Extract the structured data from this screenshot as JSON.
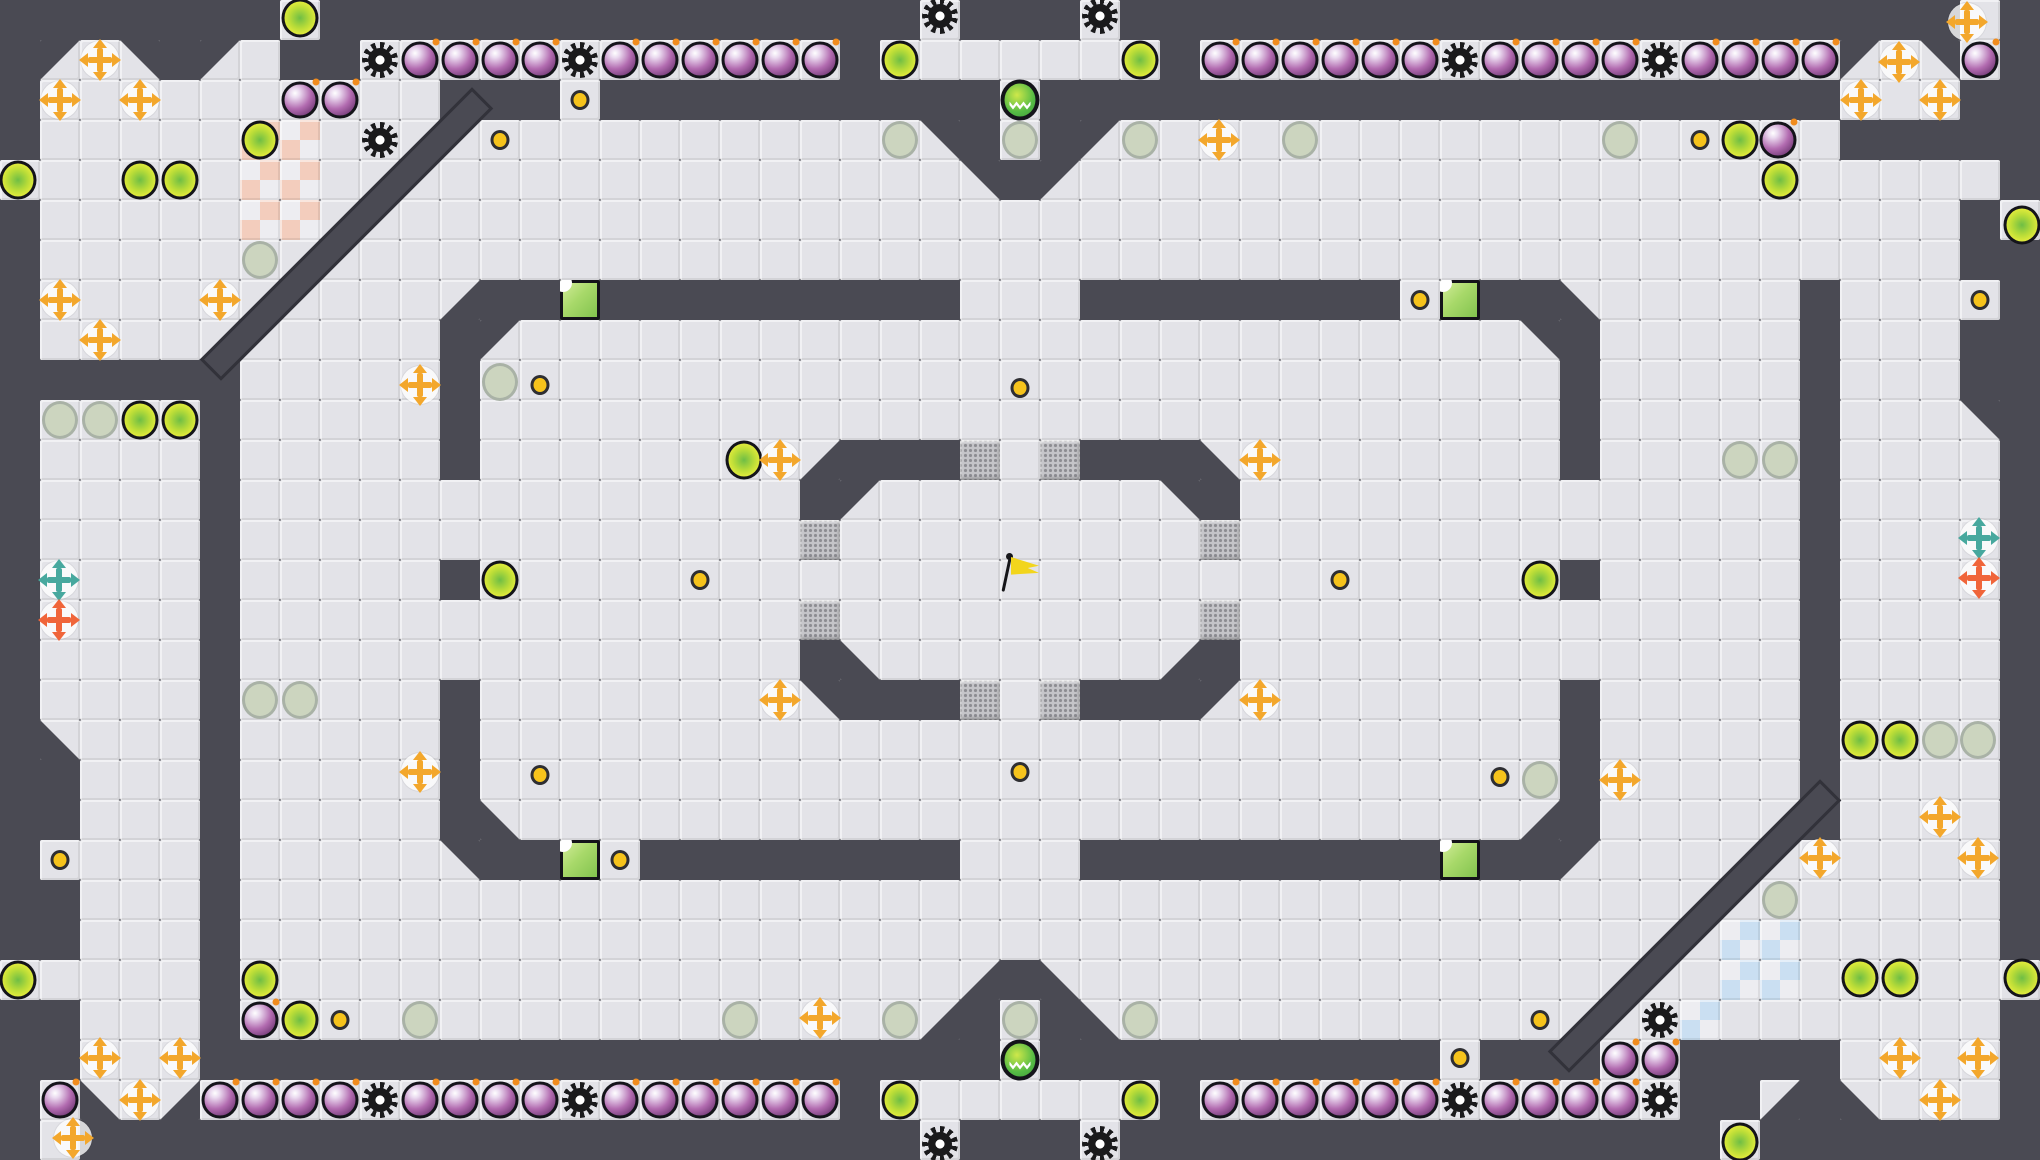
{
  "meta": {
    "description": "Top-down tile maze game map (capture-the-flag style) with neutral yellow flag at center, bomb rows, spike gears, boost pads, power-up crosses, gates, team end-zones and portals",
    "viewport": {
      "width": 2040,
      "height": 1160
    }
  },
  "map": {
    "tile": 40,
    "cols": 51,
    "rows": 29,
    "legend": {
      "#": "wall",
      ".": "floor",
      "A": "diagonal-wall-top-left",
      "B": "diagonal-wall-top-right",
      "C": "diagonal-wall-bottom-left",
      "D": "diagonal-wall-bottom-right",
      "R": "red-endzone-checker",
      "U": "blue-endzone-checker",
      "G": "gate",
      "Q": "green-button"
    },
    "grid": [
      "#######.###############.###.#####################.#",
      "#A.B#A.##............#.......#................A.B.#",
      "#..........###.##########.####################...##",
      "#.....RR...............B#.#A..................#####",
      "......RR................B#A.......................#",
      "#.....RR.........................................#.",
      "#................................................##",
      "#..........D##Q#########...########.Q##C.....#....#",
      "#..........#A.........................B#.....#...##",
      "######.....#...........................#.....#...##",
      "#....#.....#...........................#.....#...B#",
      "#....#.....#........D###G.G###C........#.....#....#",
      "#....#..............#A.......B#..............#....#",
      "#....#..............G.........G..............#....#",
      "#....#.....#...........................#.....#....#",
      "#....#..............G.........G..............#....#",
      "#....#..............#C.......D#..............#....#",
      "#....#.....#........B###G.G###A........#.....#....#",
      "#C...#.....#...........................#.....#....#",
      "##...#.....#...........................#.....#....#",
      "##...#.....#C.........................D#.....#....#",
      "#....#.....B##Q.########...#########Q##A..........#",
      "##...#............................................#",
      "##...#.....................................UU.....#",
      ".....#..................D#C................UU......",
      "##...#.................D#.#C..............U.......#",
      "##...####################.##########.###..####....#",
      "#.C.D................#.......#............##D#C...#",
      "#.#####################.###.###############.#######"
    ],
    "diagonal_walls": [
      {
        "cx": 346,
        "cy": 234,
        "len": 385,
        "w": 30,
        "angle": -45
      },
      {
        "cx": 1694,
        "cy": 926,
        "len": 385,
        "w": 30,
        "angle": -45
      }
    ]
  },
  "items": {
    "flag": [
      [
        1020,
        574
      ]
    ],
    "portals": [
      [
        1020,
        100
      ],
      [
        1020,
        1060
      ]
    ],
    "bombs": [
      [
        420,
        60
      ],
      [
        460,
        60
      ],
      [
        500,
        60
      ],
      [
        540,
        60
      ],
      [
        620,
        60
      ],
      [
        660,
        60
      ],
      [
        700,
        60
      ],
      [
        740,
        60
      ],
      [
        780,
        60
      ],
      [
        820,
        60
      ],
      [
        1220,
        60
      ],
      [
        1260,
        60
      ],
      [
        1300,
        60
      ],
      [
        1340,
        60
      ],
      [
        1380,
        60
      ],
      [
        1420,
        60
      ],
      [
        1500,
        60
      ],
      [
        1540,
        60
      ],
      [
        1580,
        60
      ],
      [
        1620,
        60
      ],
      [
        1700,
        60
      ],
      [
        1740,
        60
      ],
      [
        1780,
        60
      ],
      [
        1820,
        60
      ],
      [
        1980,
        60
      ],
      [
        300,
        100
      ],
      [
        340,
        100
      ],
      [
        1778,
        140
      ],
      [
        220,
        1100
      ],
      [
        260,
        1100
      ],
      [
        300,
        1100
      ],
      [
        340,
        1100
      ],
      [
        420,
        1100
      ],
      [
        460,
        1100
      ],
      [
        500,
        1100
      ],
      [
        540,
        1100
      ],
      [
        620,
        1100
      ],
      [
        660,
        1100
      ],
      [
        700,
        1100
      ],
      [
        740,
        1100
      ],
      [
        780,
        1100
      ],
      [
        820,
        1100
      ],
      [
        1220,
        1100
      ],
      [
        1260,
        1100
      ],
      [
        1300,
        1100
      ],
      [
        1340,
        1100
      ],
      [
        1380,
        1100
      ],
      [
        1420,
        1100
      ],
      [
        1500,
        1100
      ],
      [
        1540,
        1100
      ],
      [
        1580,
        1100
      ],
      [
        1620,
        1100
      ],
      [
        60,
        1100
      ],
      [
        260,
        1020
      ],
      [
        1620,
        1060
      ],
      [
        1660,
        1060
      ]
    ],
    "gears": [
      [
        940,
        16
      ],
      [
        1100,
        16
      ],
      [
        380,
        60
      ],
      [
        580,
        60
      ],
      [
        1460,
        60
      ],
      [
        1660,
        60
      ],
      [
        380,
        140
      ],
      [
        380,
        1100
      ],
      [
        580,
        1100
      ],
      [
        1460,
        1100
      ],
      [
        1660,
        1100
      ],
      [
        1660,
        1020
      ],
      [
        940,
        1144
      ],
      [
        1100,
        1144
      ]
    ],
    "boosts": [
      [
        300,
        18
      ],
      [
        900,
        60
      ],
      [
        1140,
        60
      ],
      [
        18,
        180
      ],
      [
        140,
        180
      ],
      [
        180,
        180
      ],
      [
        260,
        140
      ],
      [
        1740,
        140
      ],
      [
        1780,
        180
      ],
      [
        2022,
        225
      ],
      [
        140,
        420
      ],
      [
        180,
        420
      ],
      [
        744,
        460
      ],
      [
        500,
        580
      ],
      [
        1540,
        580
      ],
      [
        1860,
        740
      ],
      [
        1900,
        740
      ],
      [
        18,
        980
      ],
      [
        260,
        980
      ],
      [
        300,
        1020
      ],
      [
        900,
        1100
      ],
      [
        1140,
        1100
      ],
      [
        1860,
        978
      ],
      [
        1900,
        978
      ],
      [
        2022,
        978
      ],
      [
        1740,
        1142
      ]
    ],
    "pale_circles": [
      [
        900,
        140
      ],
      [
        1020,
        140
      ],
      [
        1140,
        140
      ],
      [
        1300,
        140
      ],
      [
        1620,
        140
      ],
      [
        260,
        260
      ],
      [
        60,
        420
      ],
      [
        100,
        420
      ],
      [
        500,
        382
      ],
      [
        260,
        700
      ],
      [
        300,
        700
      ],
      [
        1740,
        460
      ],
      [
        1780,
        460
      ],
      [
        1940,
        740
      ],
      [
        1978,
        740
      ],
      [
        1540,
        780
      ],
      [
        1780,
        900
      ],
      [
        740,
        1020
      ],
      [
        900,
        1020
      ],
      [
        1140,
        1020
      ],
      [
        1020,
        1020
      ],
      [
        420,
        1020
      ]
    ],
    "yellow_dots": [
      [
        580,
        100
      ],
      [
        500,
        140
      ],
      [
        1700,
        140
      ],
      [
        1020,
        388
      ],
      [
        540,
        385
      ],
      [
        1980,
        300
      ],
      [
        1420,
        300
      ],
      [
        700,
        580
      ],
      [
        1340,
        580
      ],
      [
        60,
        860
      ],
      [
        620,
        860
      ],
      [
        1020,
        772
      ],
      [
        540,
        775
      ],
      [
        1500,
        777
      ],
      [
        340,
        1020
      ],
      [
        1540,
        1020
      ],
      [
        1460,
        1058
      ]
    ],
    "crosses_yellow": [
      [
        100,
        60
      ],
      [
        60,
        100
      ],
      [
        140,
        100
      ],
      [
        1899,
        62
      ],
      [
        1861,
        100
      ],
      [
        1940,
        100
      ],
      [
        1967,
        22
      ],
      [
        1219,
        140
      ],
      [
        60,
        300
      ],
      [
        220,
        300
      ],
      [
        100,
        340
      ],
      [
        420,
        385
      ],
      [
        780,
        460
      ],
      [
        1260,
        460
      ],
      [
        780,
        700
      ],
      [
        1260,
        700
      ],
      [
        420,
        772
      ],
      [
        1620,
        780
      ],
      [
        1940,
        817
      ],
      [
        1820,
        858
      ],
      [
        1978,
        858
      ],
      [
        100,
        1058
      ],
      [
        180,
        1058
      ],
      [
        820,
        1018
      ],
      [
        140,
        1100
      ],
      [
        1900,
        1058
      ],
      [
        1978,
        1058
      ],
      [
        1940,
        1100
      ],
      [
        73,
        1138
      ]
    ],
    "crosses_teal": [
      [
        59,
        580
      ],
      [
        1979,
        538
      ]
    ],
    "crosses_orange": [
      [
        59,
        620
      ],
      [
        1979,
        578
      ]
    ]
  },
  "colors": {
    "wall": "#4a4a53",
    "wall_edge": "#32323a",
    "floor": "#e3e3e8",
    "checker_base": "#ededf1",
    "checker_red": "#f3cdbd",
    "checker_blue": "#cadff2",
    "gate_bg": "#c4c4c8",
    "gate_dot": "#8d8d92",
    "button_light": "#d9efa0",
    "button_dark": "#7cc04a",
    "ink": "#14141a",
    "bomb_mid": "#b26bb0",
    "bomb_dark": "#6b3470",
    "fuse_orange": "#f08c1e",
    "gear_black": "#1a1a1c",
    "boost_outer": "#e4ec3c",
    "boost_core": "#6fbe45",
    "pale_fill": "#ccd5bf",
    "pale_edge": "#a9b2a6",
    "dot_yellow": "#f6c31c",
    "cross_yellow": "#f3a72c",
    "cross_teal": "#47a89e",
    "cross_orange": "#f0653a",
    "portal_green": "#55bb45",
    "portal_lime": "#cfe84a",
    "flag_yellow": "#f2d51c",
    "flag_pole": "#16161a"
  }
}
